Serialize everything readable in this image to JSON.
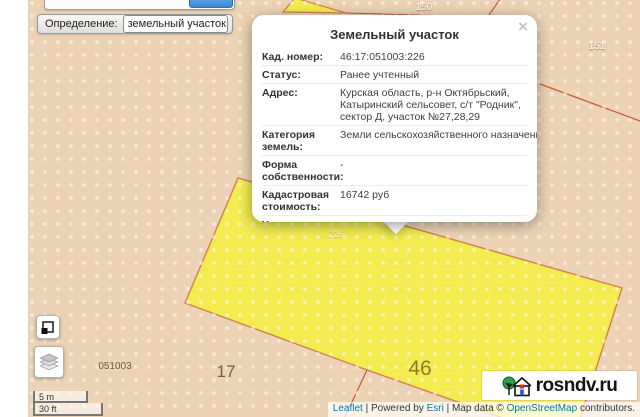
{
  "filter": {
    "label": "Определение:",
    "selected_option": "земельный участок"
  },
  "popup": {
    "title": "Земельный участок",
    "close_glyph": "×",
    "fields": [
      {
        "label": "Кад. номер:",
        "value": "46:17:051003:226"
      },
      {
        "label": "Статус:",
        "value": "Ранее учтенный"
      },
      {
        "label": "Адрес:",
        "value": "Курская область, р-н Октябрьский, Катыринский сельсовет, с/т \"Родник\", сектор Д, участок №27,28,29"
      },
      {
        "label": "Категория земель:",
        "value": "Земли сельскохозяйственного назначения"
      },
      {
        "label": "Форма собственности:",
        "value": "-"
      },
      {
        "label": "Кадастровая стоимость:",
        "value": "16742 руб"
      },
      {
        "label": "Уточненная",
        "value": ""
      }
    ]
  },
  "map": {
    "labels": {
      "quarter_top": "150",
      "quarter_right": "151",
      "parcel_226": "226",
      "block_code": "051003",
      "parcel_17": "17",
      "parcel_46": "46"
    }
  },
  "icons": {
    "dropdown_arrow": "▼",
    "area_select": "area-select-icon",
    "layers": "layers-icon"
  },
  "scale": {
    "metric": "5 m",
    "imperial": "30 ft"
  },
  "attribution": {
    "leaflet": "Leaflet",
    "sep1": " | Powered by ",
    "esri": "Esri",
    "sep2": " | Map data © ",
    "osm": "OpenStreetMap",
    "suffix": " contributors."
  },
  "watermark": {
    "text": "rosndv.ru"
  },
  "colors": {
    "map_background": "#edd3b5",
    "parcel_fill": "#f2ec51",
    "parcel_stroke": "#d2804c",
    "boundary_line": "#c2573f",
    "link": "#0078a8",
    "label_46": "#8c7d26"
  }
}
